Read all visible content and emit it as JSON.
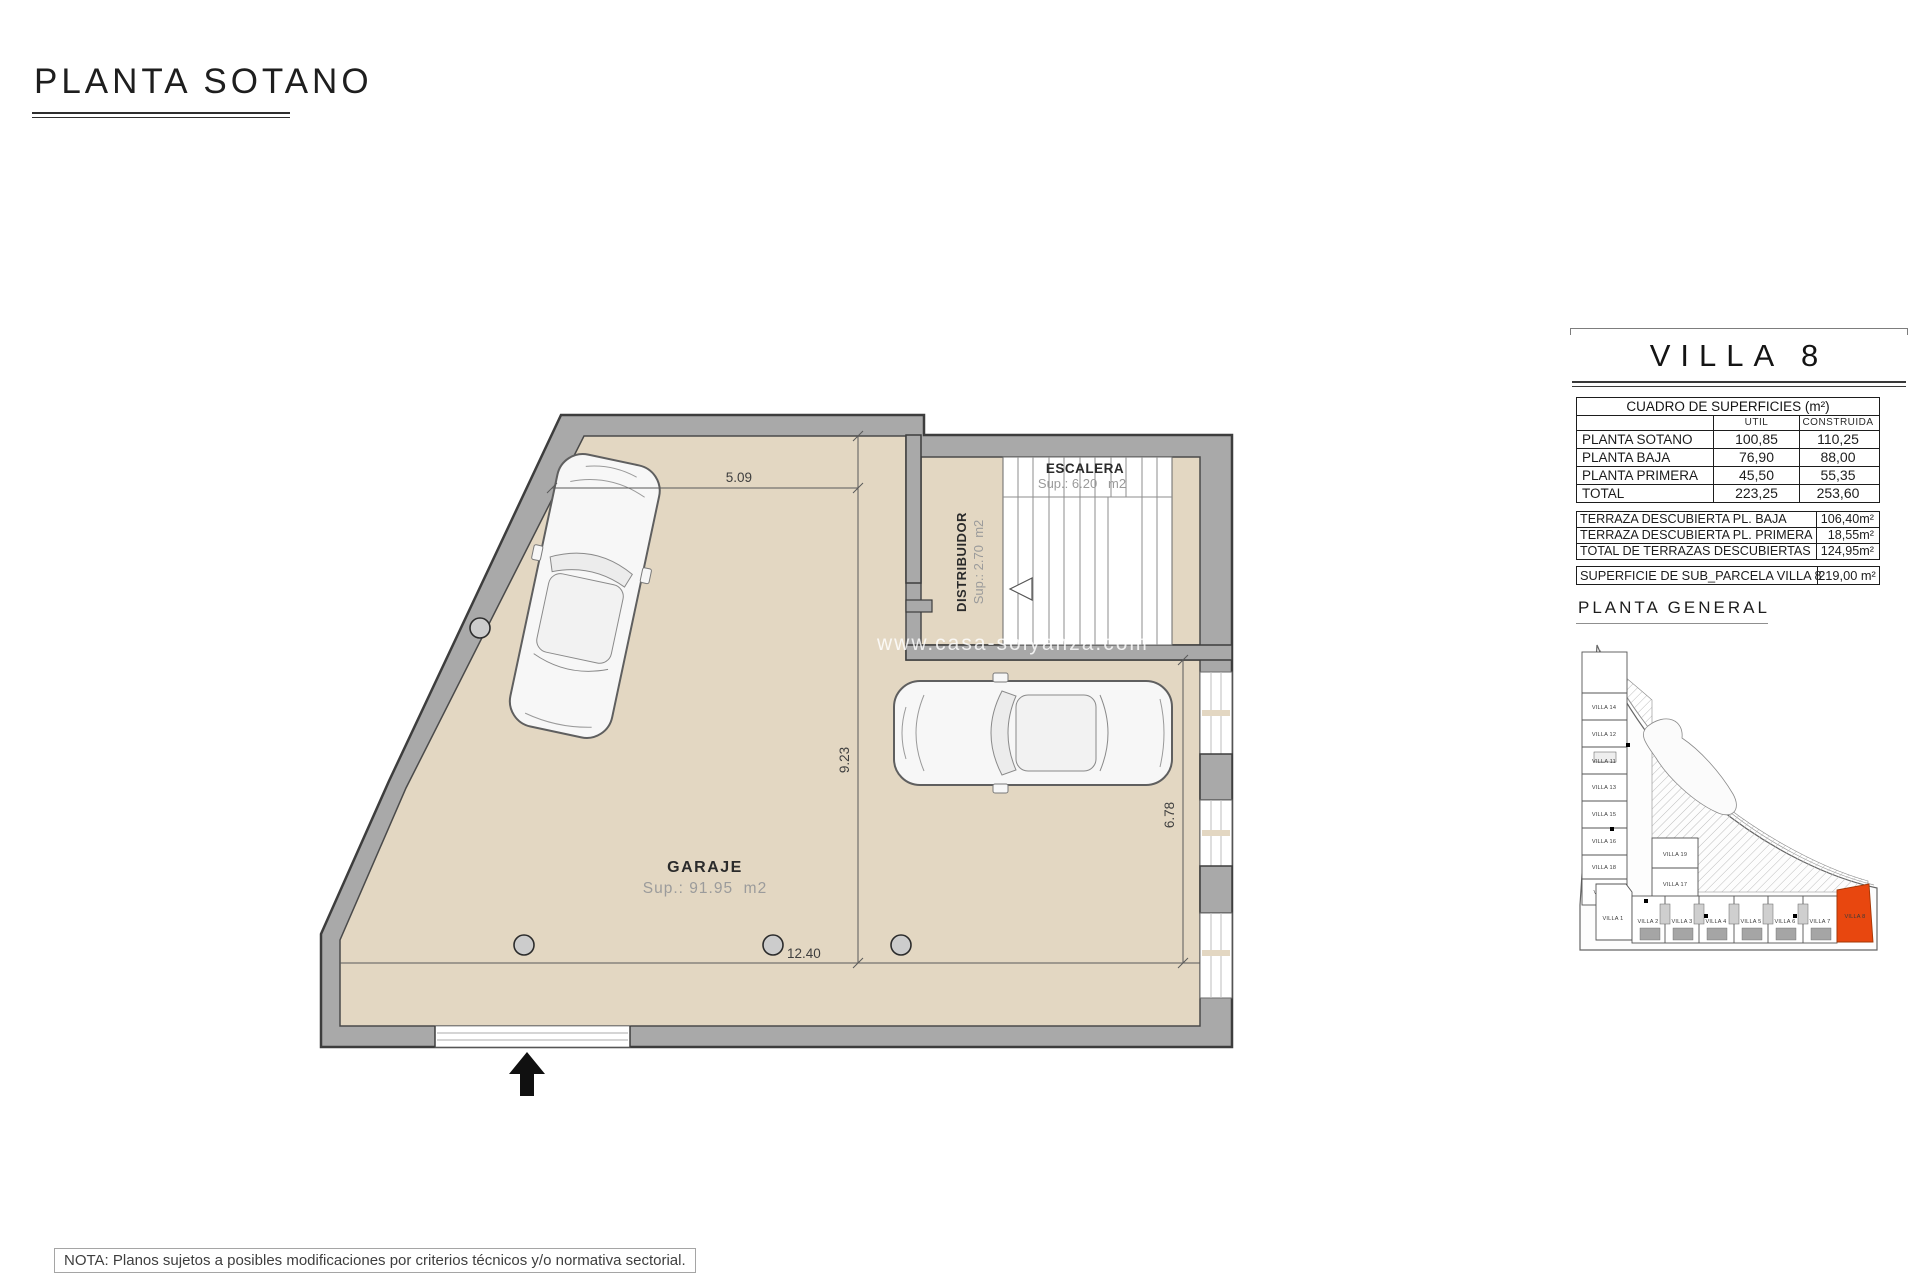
{
  "page": {
    "title": "PLANTA SOTANO",
    "watermark": "www.casa-solyanza.com",
    "note": "NOTA: Planos sujetos a posibles modificaciones por criterios técnicos y/o normativa sectorial."
  },
  "plan": {
    "rooms": {
      "garage": {
        "name": "GARAJE",
        "area": "Sup.: 91.95  m2"
      },
      "stairs": {
        "name": "ESCALERA",
        "area": "Sup.: 6.20   m2"
      },
      "distributor": {
        "name": "DISTRIBUIDOR",
        "area": "Sup.: 2.70  m2"
      }
    },
    "dimensions": {
      "top_width": "5.09",
      "garage_depth": "9.23",
      "right_depth": "6.78",
      "bottom_width": "12.40"
    }
  },
  "titleblock": {
    "villa_title": "VILLA 8",
    "surfaces": {
      "title": "CUADRO DE SUPERFICIES (m²)",
      "columns": {
        "util": "UTIL",
        "construida": "CONSTRUIDA"
      },
      "rows": [
        {
          "label": "PLANTA SOTANO",
          "util": "100,85",
          "construida": "110,25"
        },
        {
          "label": "PLANTA BAJA",
          "util": "76,90",
          "construida": "88,00"
        },
        {
          "label": "PLANTA PRIMERA",
          "util": "45,50",
          "construida": "55,35"
        },
        {
          "label": "TOTAL",
          "util": "223,25",
          "construida": "253,60"
        }
      ]
    },
    "terraces": [
      {
        "label": "TERRAZA DESCUBIERTA PL. BAJA",
        "value": "106,40m²"
      },
      {
        "label": "TERRAZA DESCUBIERTA PL. PRIMERA",
        "value": "18,55m²"
      },
      {
        "label": "TOTAL DE TERRAZAS DESCUBIERTAS",
        "value": "124,95m²"
      }
    ],
    "parcel": {
      "label": "SUPERFICIE DE SUB_PARCELA VILLA 8",
      "value": "219,00 m²"
    },
    "site_plan_title": "PLANTA GENERAL"
  },
  "site_plan": {
    "left_column": [
      "VILLA 14",
      "VILLA 12",
      "VILLA 11",
      "VILLA 13",
      "VILLA 15",
      "VILLA 16",
      "VILLA 18",
      "VILLA 9"
    ],
    "middle_column": [
      "VILLA 19",
      "VILLA 17"
    ],
    "bottom_row": [
      "VILLA 1",
      "VILLA 2",
      "VILLA 3",
      "VILLA 4",
      "VILLA 5",
      "VILLA 6",
      "VILLA 7",
      "VILLA 8"
    ],
    "highlighted_villa": "VILLA 8",
    "highlight_color": "#E8470F"
  },
  "colors": {
    "wall": "#A9A9A9",
    "floor": "#E3D7C2",
    "accent": "#E8470F"
  }
}
